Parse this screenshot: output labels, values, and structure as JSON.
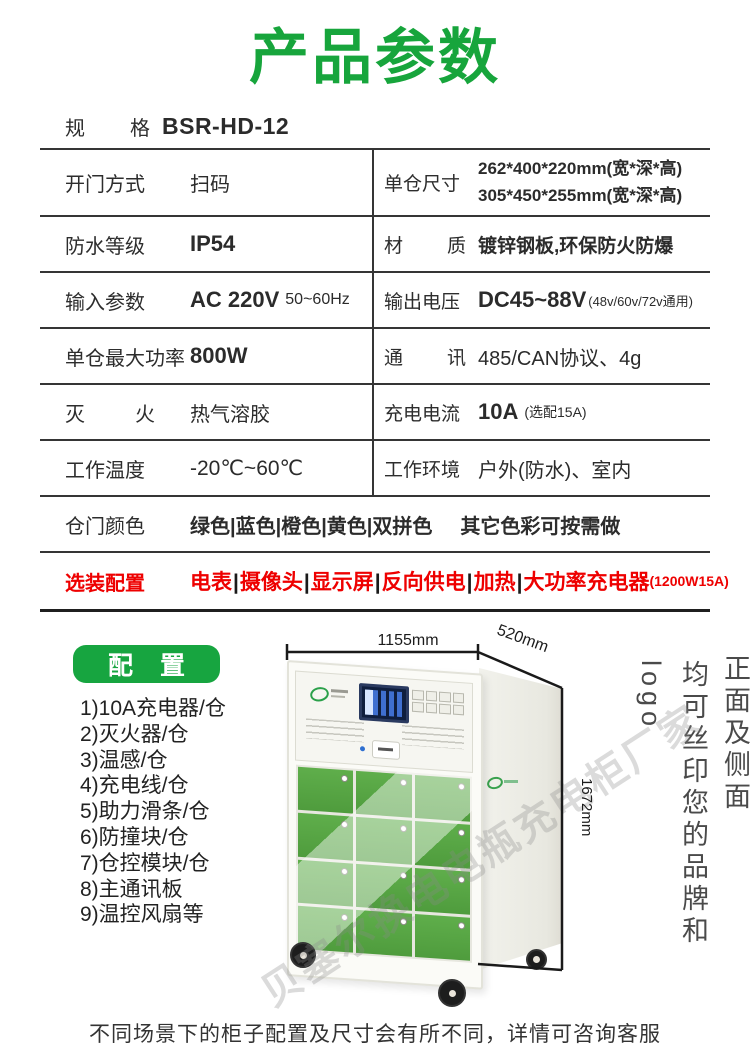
{
  "colors": {
    "accent_green": "#17a53c",
    "badge_green": "#17a540",
    "optional_red": "#ee0000",
    "door_green": "#55a344"
  },
  "header": {
    "title": "产品参数"
  },
  "table": {
    "model": {
      "label": "规 格",
      "value": "BSR-HD-12"
    },
    "door_method": {
      "label": "开门方式",
      "value": "扫码"
    },
    "compartment_size": {
      "label": "单仓尺寸",
      "line1": "262*400*220mm(宽*深*高)",
      "line2": "305*450*255mm(宽*深*高)"
    },
    "waterproof": {
      "label": "防水等级",
      "value": "IP54"
    },
    "material": {
      "label": "材 质",
      "value": "镀锌钢板,环保防火防爆"
    },
    "input_power": {
      "label": "输入参数",
      "value": "AC 220V",
      "sub": "50~60Hz"
    },
    "output_voltage": {
      "label": "输出电压",
      "value": "DC45~88V",
      "sub": "(48v/60v/72v通用)"
    },
    "max_power": {
      "label": "单仓最大功率",
      "value": "800W"
    },
    "communication": {
      "label": "通 讯",
      "value": "485/CAN协议、4g"
    },
    "fire_control": {
      "label": "灭 火",
      "value": "热气溶胶"
    },
    "charge_current": {
      "label": "充电电流",
      "value": "10A",
      "sub": "(选配15A)"
    },
    "work_temp": {
      "label": "工作温度",
      "value": "-20℃~60℃"
    },
    "work_env": {
      "label": "工作环境",
      "value": "户外(防水)、室内"
    },
    "door_color": {
      "label": "仓门颜色",
      "value": "绿色|蓝色|橙色|黄色|双拼色",
      "note": "其它色彩可按需做"
    },
    "optional": {
      "label": "选装配置",
      "items": [
        "电表",
        "摄像头",
        "显示屏",
        "反向供电",
        "加热",
        "大功率充电器"
      ],
      "separator": "|",
      "suffix": "(1200W15A)"
    }
  },
  "config": {
    "badge": "配 置",
    "items": [
      "1)10A充电器/仓",
      "2)灭火器/仓",
      "3)温感/仓",
      "4)充电线/仓",
      "5)助力滑条/仓",
      "6)防撞块/仓",
      "7)仓控模块/仓",
      "8)主通讯板",
      "9)温控风扇等"
    ]
  },
  "product": {
    "dim_width": "1155mm",
    "dim_depth": "520mm",
    "dim_height": "1672mm",
    "door_rows": 4,
    "door_cols": 3,
    "watermark": "贝塞尔换电电瓶充电柜厂家",
    "side_note_line1": "正面及侧面",
    "side_note_line2": "均可丝印您的品牌和logo"
  },
  "footer": {
    "note": "不同场景下的柜子配置及尺寸会有所不同，详情可咨询客服"
  }
}
